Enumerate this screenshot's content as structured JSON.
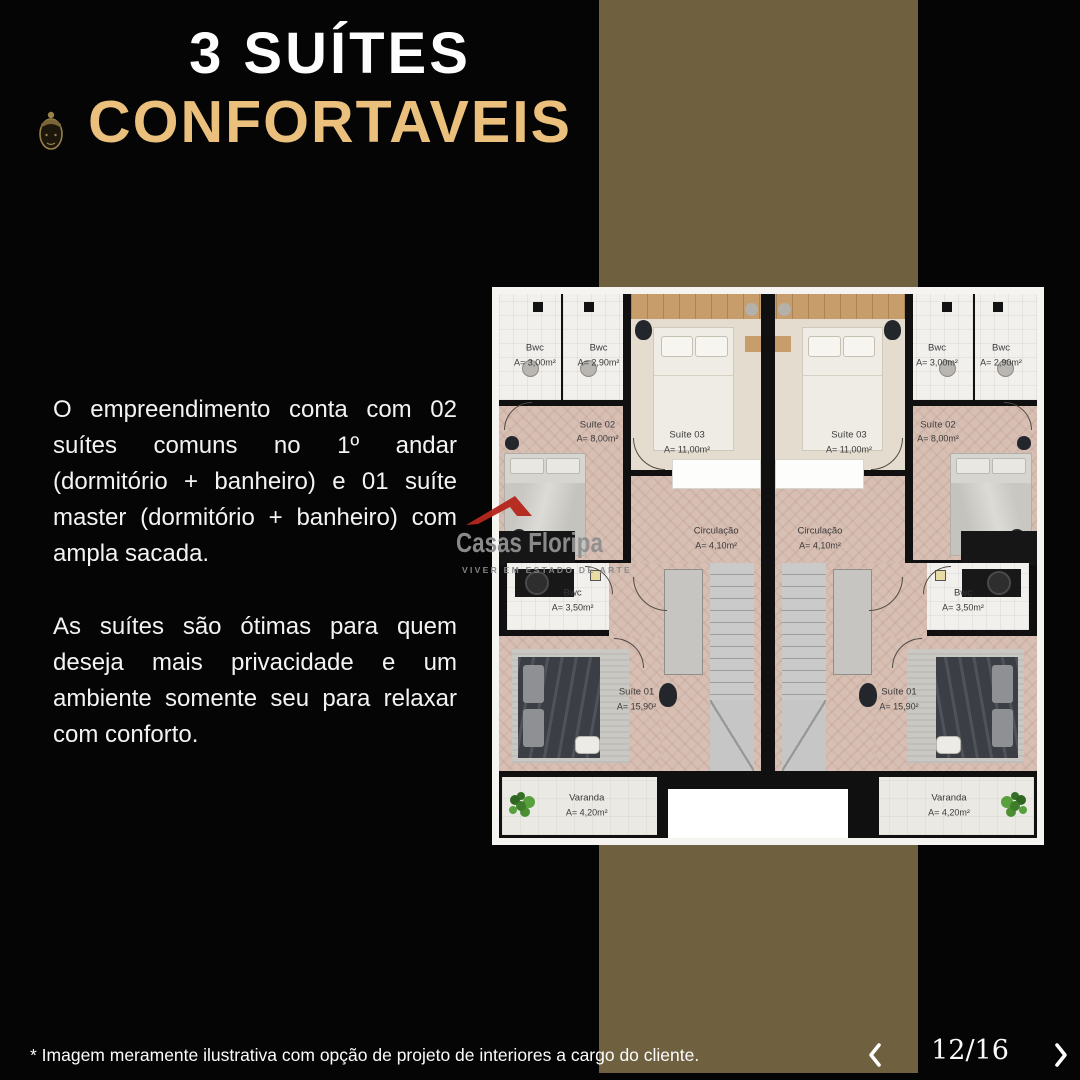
{
  "header": {
    "title_line1": "3 SUÍTES",
    "title_line2": "CONFORTAVEIS"
  },
  "description": {
    "paragraph1": "O empreendimento conta com 02 suítes comuns no 1º andar (dormitório + banheiro) e 01 suíte master (dormitório + banheiro) com ampla sacada.",
    "paragraph2": "As suítes são ótimas para quem deseja mais privacidade e um ambiente somente seu para relaxar com conforto."
  },
  "brand": {
    "name": "Casas Floripa",
    "tagline": "VIVER EM ESTADO DE ARTE"
  },
  "floorplan": {
    "rooms": {
      "bwc_a": {
        "name": "Bwc",
        "area": "A= 3,00m²"
      },
      "bwc_b": {
        "name": "Bwc",
        "area": "A= 2,90m²"
      },
      "suite02": {
        "name": "Suíte 02",
        "area": "A= 8,00m²"
      },
      "suite03": {
        "name": "Suíte 03",
        "area": "A= 11,00m²"
      },
      "circulacao": {
        "name": "Circulação",
        "area": "A= 4,10m²"
      },
      "bwc_master": {
        "name": "Bwc",
        "area": "A= 3,50m²"
      },
      "suite01": {
        "name": "Suíte 01",
        "area": "A= 15,90²"
      },
      "varanda": {
        "name": "Varanda",
        "area": "A= 4,20m²"
      }
    }
  },
  "footer": {
    "disclaimer": "* Imagem meramente ilustrativa com opção de projeto de interiores a cargo do cliente.",
    "page_indicator": "12/16"
  },
  "colors": {
    "background": "#050505",
    "stripe_olive": "#6f6140",
    "accent_gold": "#ebc07c",
    "logo_red": "#b5271d",
    "logo_gray": "#8f8f8f"
  }
}
